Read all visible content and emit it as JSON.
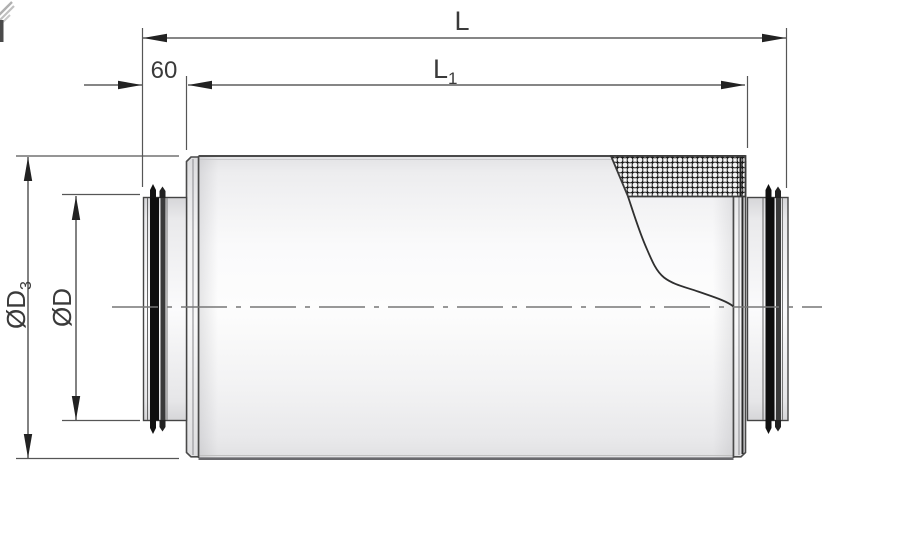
{
  "drawing": {
    "dimensions": {
      "total_length": {
        "label": "L"
      },
      "body_length": {
        "main": "L",
        "sub": "1"
      },
      "spigot_length": {
        "label": "60"
      },
      "outer_diameter": {
        "main": "ØD",
        "sub": "3"
      },
      "duct_diameter": {
        "label": "ØD"
      }
    },
    "colors": {
      "line": "#3f3f3f",
      "text": "#3a3a3a",
      "centerline": "#777777",
      "seal_black": "#0e0e0e",
      "body_highlight": "#fdfdfd",
      "body_edge": "#e6e6e8",
      "hatch_line": "#1c1c1c"
    }
  }
}
